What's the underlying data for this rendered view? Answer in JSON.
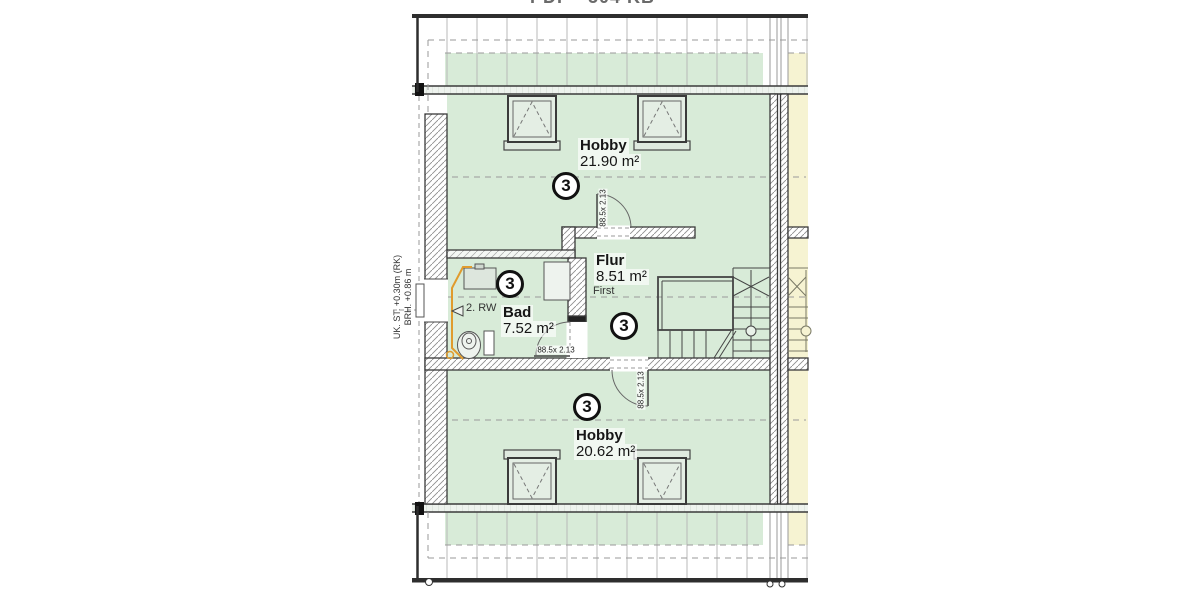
{
  "document": {
    "title": "PDF - 504 KB"
  },
  "plan": {
    "rooms": [
      {
        "id": "hobby-top",
        "name": "Hobby",
        "area": "21.90 m²",
        "circle": "3"
      },
      {
        "id": "flur",
        "name": "Flur",
        "area": "8.51 m²",
        "circle": "3"
      },
      {
        "id": "bad",
        "name": "Bad",
        "area": "7.52 m²",
        "circle": "3"
      },
      {
        "id": "hobby-bottom",
        "name": "Hobby",
        "area": "20.62 m²",
        "circle": "3"
      }
    ],
    "doors": [
      {
        "id": "door-hobby-top",
        "size": "88.5x 2.13"
      },
      {
        "id": "door-bad",
        "size": "88.5x 2.13"
      },
      {
        "id": "door-hobby-bottom",
        "size": "88.5x 2.13"
      }
    ],
    "annotations": {
      "ridge": "First",
      "rainwater": "2. RW",
      "sill_line1": "UK. ST. +0.30m (RK)",
      "sill_line2": "BRH. +0.86 m"
    },
    "colors": {
      "room_fill": "#d8ebd8",
      "neighbor_fill": "#f6f3d2",
      "pipe": "#e09b2d",
      "line": "#3a3a3a",
      "dash": "#9a9a9a"
    }
  }
}
